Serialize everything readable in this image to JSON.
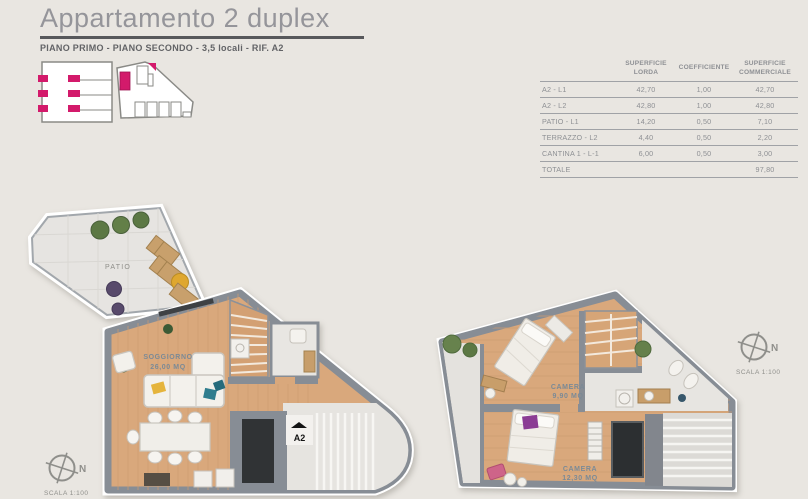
{
  "header": {
    "title": "Appartamento 2 duplex",
    "subtitle": "PIANO PRIMO - PIANO SECONDO - 3,5 locali - RIF. A2"
  },
  "area_table": {
    "col_headers": [
      "SUPERFICIE LORDA",
      "COEFFICIENTE",
      "SUPERFICIE COMMERCIALE"
    ],
    "rows": [
      {
        "label": "A2 - L1",
        "lorda": "42,70",
        "coefficiente": "1,00",
        "commerciale": "42,70"
      },
      {
        "label": "A2 - L2",
        "lorda": "42,80",
        "coefficiente": "1,00",
        "commerciale": "42,80"
      },
      {
        "label": "PATIO - L1",
        "lorda": "14,20",
        "coefficiente": "0,50",
        "commerciale": "7,10"
      },
      {
        "label": "TERRAZZO - L2",
        "lorda": "4,40",
        "coefficiente": "0,50",
        "commerciale": "2,20"
      },
      {
        "label": "CANTINA 1 - L-1",
        "lorda": "6,00",
        "coefficiente": "0,50",
        "commerciale": "3,00"
      }
    ],
    "total_label": "TOTALE",
    "total_value": "97,80"
  },
  "floor_plan_left": {
    "patio_label": "PATIO",
    "living_label": "SOGGIORNO",
    "living_area": "26,00 MQ",
    "entrance_label": "A2"
  },
  "floor_plan_right": {
    "bedroom1_label": "CAMERA",
    "bedroom1_area": "9,90 MQ",
    "bedroom2_label": "CAMERA",
    "bedroom2_area": "12,30 MQ"
  },
  "compass": {
    "north": "N",
    "scale": "SCALA 1:100"
  },
  "colors": {
    "background": "#e9e6e1",
    "wall_gray": "#878d95",
    "wood_floor": "#d9a87c",
    "patio_floor": "#e6e4e1",
    "accent_pink": "#d31a6b",
    "title_gray": "#95959a"
  }
}
